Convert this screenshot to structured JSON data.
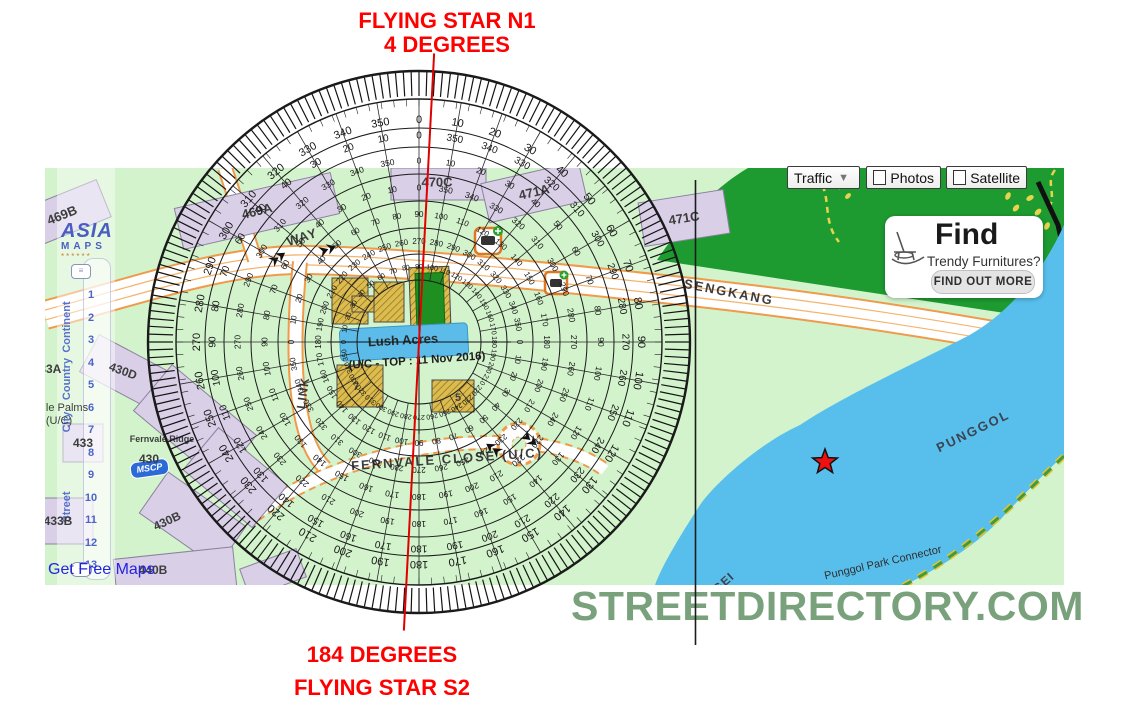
{
  "annotations": {
    "top_line1": "FLYING STAR N1",
    "top_line2": "4 DEGREES",
    "bottom_line1": "184 DEGREES",
    "bottom_line2": "FLYING STAR S2",
    "color": "#ff0000"
  },
  "watermark": "STREETDIRECTORY.COM",
  "map_controls": {
    "traffic_label": "Traffic",
    "photos_label": "Photos",
    "satellite_label": "Satellite"
  },
  "ad_card": {
    "title": "Find",
    "subtitle": "Trendy Furnitures?",
    "cta": "FIND OUT MORE",
    "icon": "rocking-chair-icon"
  },
  "sidebar": {
    "logo_line1": "ASIA",
    "logo_line2": "MAPS",
    "logo_line3": "******",
    "scale_words": [
      {
        "text": "Continent",
        "y": 159
      },
      {
        "text": "Country",
        "y": 211
      },
      {
        "text": "City",
        "y": 254
      },
      {
        "text": "Street",
        "y": 339
      }
    ],
    "zoom_levels": [
      "1",
      "2",
      "3",
      "4",
      "5",
      "6",
      "7",
      "8",
      "9",
      "10",
      "11",
      "12",
      "13"
    ],
    "footer_link": "Get Free Maps",
    "mscp_badge": "MSCP"
  },
  "map_labels": {
    "items": [
      {
        "id": "bldg-469B",
        "text": "469B",
        "x": 17,
        "y": 47,
        "rot": -22,
        "fs": 13
      },
      {
        "id": "bldg-469A",
        "text": "469A",
        "x": 212,
        "y": 43,
        "rot": -14,
        "fs": 13
      },
      {
        "id": "bldg-470C",
        "text": "470C",
        "x": 392,
        "y": 14,
        "rot": 0,
        "fs": 13
      },
      {
        "id": "bldg-471A",
        "text": "471A",
        "x": 489,
        "y": 24,
        "rot": -13,
        "fs": 13
      },
      {
        "id": "bldg-471C",
        "text": "471C",
        "x": 639,
        "y": 50,
        "rot": -9,
        "fs": 13
      },
      {
        "id": "bldg-430D",
        "text": "430D",
        "x": 78,
        "y": 203,
        "rot": 20,
        "fs": 12
      },
      {
        "id": "bldg-433A",
        "text": "433A",
        "x": 2,
        "y": 201,
        "rot": 0,
        "fs": 12
      },
      {
        "id": "bldg-433",
        "text": "433",
        "x": 38,
        "y": 275,
        "rot": 0,
        "fs": 12
      },
      {
        "id": "bldg-fernvale-ridge",
        "text": "Fernvale Ridge",
        "x": 117,
        "y": 271,
        "rot": 0,
        "fs": 9
      },
      {
        "id": "bldg-430",
        "text": "430",
        "x": 104,
        "y": 291,
        "rot": 0,
        "fs": 12
      },
      {
        "id": "bldg-430B",
        "text": "430B",
        "x": 122,
        "y": 353,
        "rot": -25,
        "fs": 12
      },
      {
        "id": "bldg-433B",
        "text": "433B",
        "x": 13,
        "y": 353,
        "rot": 0,
        "fs": 12
      },
      {
        "id": "bldg-440B",
        "text": "440B",
        "x": 108,
        "y": 402,
        "rot": 0,
        "fs": 12
      },
      {
        "id": "lbl-le-palms",
        "text": "le Palms",
        "x": 22,
        "y": 240,
        "rot": 0,
        "fs": 11,
        "weight": "normal"
      },
      {
        "id": "lbl-le-palms-uc",
        "text": "(U/C)",
        "x": 14,
        "y": 253,
        "rot": 0,
        "fs": 11,
        "weight": "normal"
      },
      {
        "id": "block-7",
        "text": "7",
        "x": 311,
        "y": 219,
        "rot": 0,
        "fs": 11
      },
      {
        "id": "block-5",
        "text": "5",
        "x": 413,
        "y": 230,
        "rot": 0,
        "fs": 11
      },
      {
        "id": "estate-lush-acres",
        "text": "Lush Acres",
        "x": 358,
        "y": 172,
        "rot": -3,
        "fs": 13,
        "color": "#2b2b2b"
      },
      {
        "id": "estate-lush-note",
        "text": "(U/C - TOP : 11 Nov 2016)",
        "x": 372,
        "y": 193,
        "rot": -4,
        "fs": 11.5,
        "color": "#1e1e1e"
      },
      {
        "id": "road-way",
        "text": "WAY",
        "x": 257,
        "y": 69,
        "rot": -18,
        "fs": 13,
        "ls": 1
      },
      {
        "id": "road-link",
        "text": "LINK",
        "x": 258,
        "y": 225,
        "rot": -82,
        "fs": 12,
        "ls": 1
      },
      {
        "id": "road-fernvale-close",
        "text": "FERNVALE  CLOSE  (U/C)",
        "x": 402,
        "y": 291,
        "rot": -4,
        "fs": 13,
        "ls": 2
      },
      {
        "id": "road-sengkang",
        "text": "SENGKANG",
        "x": 684,
        "y": 124,
        "rot": 11,
        "fs": 13,
        "ls": 2
      },
      {
        "id": "water-punggol",
        "text": "PUNGGOL",
        "x": 928,
        "y": 263,
        "rot": -26,
        "fs": 13,
        "ls": 2,
        "color": "#3c4452"
      },
      {
        "id": "water-sungei",
        "text": "SUNGEI",
        "x": 668,
        "y": 424,
        "rot": -42,
        "fs": 12,
        "ls": 1,
        "color": "#3c4452"
      },
      {
        "id": "path-park-connector",
        "text": "Punggol Park Connector",
        "x": 838,
        "y": 395,
        "rot": -13,
        "fs": 11,
        "weight": "normal",
        "color": "#2e2e2e"
      }
    ]
  },
  "compass": {
    "cx": 419,
    "cy": 342,
    "outer_radius": 271,
    "tick_ring": {
      "inner": 246,
      "outer": 270,
      "count": 216
    },
    "minor_ticks": {
      "inner": 236,
      "outer": 243,
      "step": 3
    },
    "circles": [
      271,
      243,
      214,
      195,
      168,
      141,
      114,
      88,
      62
    ],
    "spokes": {
      "step": 10,
      "inner": 62,
      "outer": 243
    },
    "label_rings": [
      {
        "r": 222,
        "dir": 1,
        "offset": 0,
        "fs": 11
      },
      {
        "r": 206,
        "dir": -1,
        "offset": 0,
        "fs": 10
      },
      {
        "r": 181,
        "dir": 1,
        "offset": 0,
        "fs": 8.5
      },
      {
        "r": 154,
        "dir": -1,
        "offset": 0,
        "fs": 8.5
      },
      {
        "r": 127,
        "dir": 1,
        "offset": 90,
        "fs": 8
      },
      {
        "r": 100,
        "dir": 1,
        "offset": -90,
        "fs": 8
      },
      {
        "r": 75,
        "dir": 1,
        "offset": 90,
        "fs": 7
      }
    ],
    "crosshair_radius": 92,
    "facing_line": {
      "visual_angle_deg": 3,
      "color": "#e10000",
      "length": 289
    },
    "reference_line_x": 695.5
  },
  "colors": {
    "map_green": "#d2f3cb",
    "park_green": "#1e9b30",
    "river_blue": "#58bfec",
    "road_casing": "#f09a4a",
    "building_fill": "#d9cfe7",
    "building_stroke": "#8d81a0",
    "construction_yellow": "#dcbc4e",
    "watermark_green": "#78a17c",
    "annotation_red": "#ff0000",
    "marker_red": "#ee1111"
  }
}
